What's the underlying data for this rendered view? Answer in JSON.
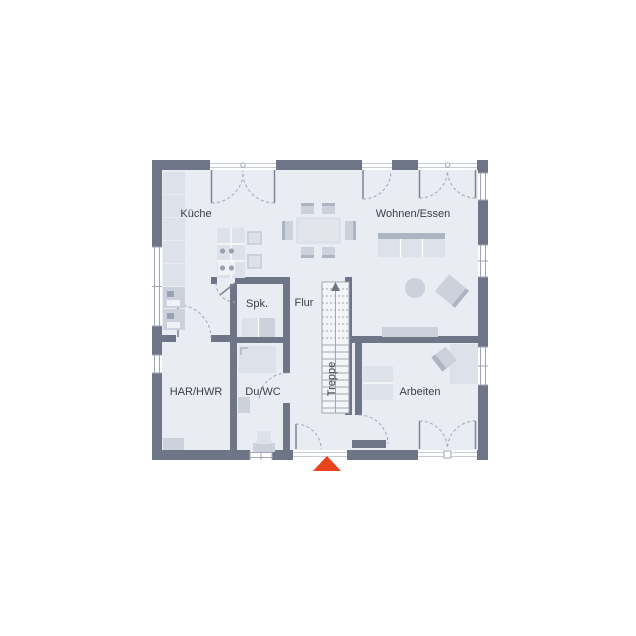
{
  "floor_plan": {
    "rooms": {
      "kueche": {
        "label": "Küche"
      },
      "wohnen_essen": {
        "label": "Wohnen/Essen"
      },
      "spk": {
        "label": "Spk."
      },
      "flur": {
        "label": "Flur"
      },
      "treppe": {
        "label": "Treppe"
      },
      "har_hwr": {
        "label": "HAR/HWR"
      },
      "du_wc": {
        "label": "Du/WC"
      },
      "arbeiten": {
        "label": "Arbeiten"
      }
    },
    "colors": {
      "background": "#ffffff",
      "wall": "#6e7587",
      "floor": "#e9ecf2",
      "furniture_light": "#dde1e9",
      "furniture_mid": "#ccd1db",
      "furniture_dark": "#aeb5c2",
      "door_line": "#a0a6b4",
      "label_text": "#3b3f48",
      "entrance_arrow": "#e8431c"
    },
    "entrance_marker": "arrow-up"
  }
}
